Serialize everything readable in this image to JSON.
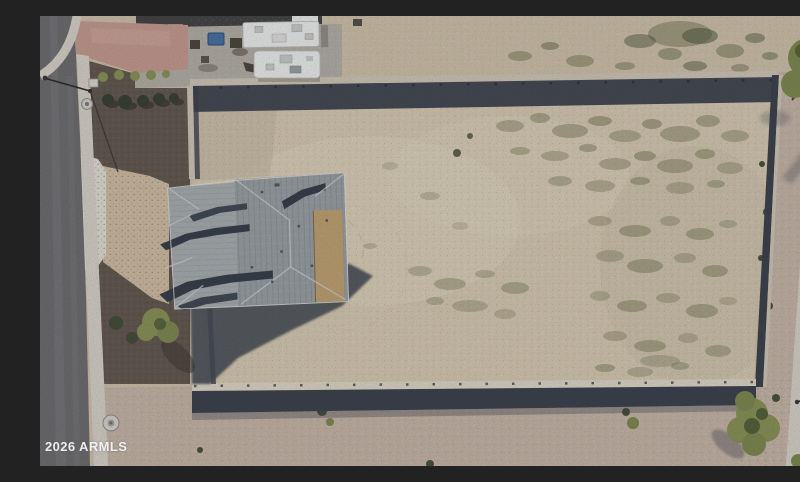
{
  "image": {
    "width": 800,
    "height": 450,
    "alt": "Aerial drone photo of a gray-roofed house on a large walled dirt lot between two streets"
  },
  "watermark": {
    "text": "2026 ARMLS"
  },
  "palette": {
    "road": "#6f6f72",
    "roadWorn": "#7e7e81",
    "sidewalk": "#d6d2c9",
    "apron": "#e0ddd5",
    "pinkDrive": "#c59b91",
    "gravelDark": "#645b52",
    "dirt": "#d6c9b3",
    "dirtLight": "#e1d6c2",
    "dirtOutside": "#cec1ab",
    "dirtGray": "#c7bba7",
    "pinkGravel": "#c6b5a8",
    "wallTop": "#cec6b7",
    "wallBright": "#ddd6c8",
    "wallShadow": "#3e4450",
    "shadow": "#474d57",
    "roofGray": "#9aa0a4",
    "roofWing": "#a9aeb1",
    "roofDark": "#39414d",
    "roofStep": "#424b57",
    "roofTan": "#bfa273",
    "roofLine": "#c9cdd0",
    "rvWhite": "#ebecec",
    "rvDetail": "#c9cbc9",
    "pad": "#b3afa8",
    "darkRoof": "#454547",
    "pinkBldg": "#b2887e",
    "blueBin": "#4a72a6",
    "treeGreen": "#7f8a52",
    "treeLight": "#8a9358",
    "treeDark": "#4a543a",
    "weed": "#8f8c70",
    "weedDark": "#747a57",
    "equip": "#4e4840"
  }
}
